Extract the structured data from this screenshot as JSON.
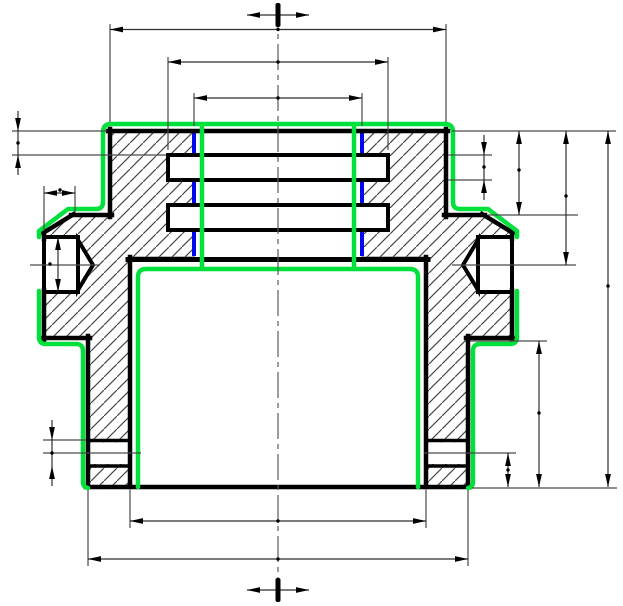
{
  "canvas": {
    "width": 623,
    "height": 606,
    "background": "#ffffff"
  },
  "colors": {
    "outline": "#000000",
    "hatch": "#474747",
    "thin": "#4a4a4a",
    "dim": "#2e2e2e",
    "arrow": "#000000",
    "highlight_green": "#00e13c",
    "highlight_blue": "#0008f0",
    "white": "#ffffff",
    "centerline": "#5a5a5a"
  },
  "strokes": {
    "outline": 4.5,
    "feature": 4,
    "groove": 3.5,
    "green": 4.5,
    "blue": 4,
    "thin": 1.2,
    "dim": 1.2,
    "hatch": 1.2,
    "hatch_period": 13
  },
  "drawing": {
    "hatch_regions": [
      {
        "name": "section-hatch-left",
        "points": [
          [
            110,
            131
          ],
          [
            194,
            131
          ],
          [
            194,
            257
          ],
          [
            130,
            257
          ],
          [
            130,
            487
          ],
          [
            88,
            487
          ],
          [
            88,
            338
          ],
          [
            44,
            338
          ],
          [
            44,
            233
          ],
          [
            73,
            215
          ],
          [
            110,
            215
          ]
        ]
      },
      {
        "name": "section-hatch-right",
        "points": [
          [
            446,
            131
          ],
          [
            362,
            131
          ],
          [
            362,
            257
          ],
          [
            426,
            257
          ],
          [
            426,
            487
          ],
          [
            468,
            487
          ],
          [
            468,
            338
          ],
          [
            512,
            338
          ],
          [
            512,
            233
          ],
          [
            483,
            215
          ],
          [
            446,
            215
          ]
        ]
      }
    ],
    "white_shapes": [
      {
        "name": "groove-band-left",
        "type": "rect",
        "x": 86,
        "y": 442.5,
        "w": 46,
        "h": 21.5,
        "stroke": false
      },
      {
        "name": "groove-band-right",
        "type": "rect",
        "x": 424,
        "y": 442.5,
        "w": 46,
        "h": 21.5,
        "stroke": false
      },
      {
        "name": "side-port-bore-left",
        "type": "rect",
        "x": 44,
        "y": 237,
        "w": 34,
        "h": 55,
        "stroke": true
      },
      {
        "name": "side-port-cone-left",
        "type": "poly",
        "points": [
          [
            78,
            240
          ],
          [
            93,
            265
          ],
          [
            78,
            290
          ]
        ],
        "stroke": true
      },
      {
        "name": "side-port-bore-right",
        "type": "rect",
        "x": 478,
        "y": 237,
        "w": 34,
        "h": 55,
        "stroke": true
      },
      {
        "name": "side-port-cone-right",
        "type": "poly",
        "points": [
          [
            478,
            240
          ],
          [
            463,
            265
          ],
          [
            478,
            290
          ]
        ],
        "stroke": true
      },
      {
        "name": "internal-ring-upper",
        "type": "rect",
        "x": 168,
        "y": 155,
        "w": 220,
        "h": 25,
        "stroke": true
      },
      {
        "name": "internal-ring-lower",
        "type": "rect",
        "x": 168,
        "y": 205,
        "w": 220,
        "h": 25,
        "stroke": true
      }
    ],
    "groove_lines": [
      {
        "name": "groove-left-top-edge",
        "x1": 86,
        "y1": 440.5,
        "x2": 132,
        "y2": 440.5
      },
      {
        "name": "groove-left-bottom-edge",
        "x1": 86,
        "y1": 466,
        "x2": 132,
        "y2": 466
      },
      {
        "name": "groove-right-top-edge",
        "x1": 424,
        "y1": 440.5,
        "x2": 470,
        "y2": 440.5
      },
      {
        "name": "groove-right-bottom-edge",
        "x1": 424,
        "y1": 466,
        "x2": 470,
        "y2": 466
      }
    ],
    "blue_edges": [
      {
        "name": "bore-edge-blue-left-1",
        "x": 194,
        "y1": 133,
        "y2": 153
      },
      {
        "name": "bore-edge-blue-left-2",
        "x": 194,
        "y1": 182,
        "y2": 203
      },
      {
        "name": "bore-edge-blue-left-3",
        "x": 194,
        "y1": 232,
        "y2": 256
      },
      {
        "name": "bore-edge-blue-right-1",
        "x": 362,
        "y1": 133,
        "y2": 153
      },
      {
        "name": "bore-edge-blue-right-2",
        "x": 362,
        "y1": 182,
        "y2": 203
      },
      {
        "name": "bore-edge-blue-right-3",
        "x": 362,
        "y1": 232,
        "y2": 256
      }
    ],
    "outline_segments": [
      {
        "name": "top-face",
        "x1": 108,
        "y1": 131,
        "x2": 448,
        "y2": 131,
        "w": 4.5
      },
      {
        "name": "outer-wall-left",
        "x1": 110,
        "y1": 129,
        "x2": 110,
        "y2": 217,
        "w": 4.5
      },
      {
        "name": "step-face-left",
        "x1": 112,
        "y1": 215,
        "x2": 71,
        "y2": 215,
        "w": 4.5
      },
      {
        "name": "chamfer-left",
        "x1": 74,
        "y1": 214,
        "x2": 43,
        "y2": 233,
        "w": 4.5
      },
      {
        "name": "flat-left-upper",
        "x1": 44,
        "y1": 231,
        "x2": 44,
        "y2": 239,
        "w": 4.5
      },
      {
        "name": "flat-left-lower",
        "x1": 44,
        "y1": 290,
        "x2": 44,
        "y2": 340,
        "w": 4.5
      },
      {
        "name": "shoulder-left",
        "x1": 42,
        "y1": 338,
        "x2": 90,
        "y2": 338,
        "w": 4.5
      },
      {
        "name": "skirt-outer-left",
        "x1": 88,
        "y1": 336,
        "x2": 88,
        "y2": 487,
        "w": 4.5
      },
      {
        "name": "bottom-face",
        "x1": 86,
        "y1": 487,
        "x2": 470,
        "y2": 487,
        "w": 4.5
      },
      {
        "name": "cavity-wall-left",
        "x1": 130,
        "y1": 257,
        "x2": 130,
        "y2": 487,
        "w": 4.5
      },
      {
        "name": "cavity-ceiling",
        "x1": 128,
        "y1": 259.5,
        "x2": 428,
        "y2": 259.5,
        "w": 5
      },
      {
        "name": "cavity-wall-right",
        "x1": 426,
        "y1": 257,
        "x2": 426,
        "y2": 487,
        "w": 4.5
      },
      {
        "name": "skirt-outer-right",
        "x1": 468,
        "y1": 336,
        "x2": 468,
        "y2": 487,
        "w": 4.5
      },
      {
        "name": "shoulder-right",
        "x1": 466,
        "y1": 338,
        "x2": 514,
        "y2": 338,
        "w": 4.5
      },
      {
        "name": "flat-right-lower",
        "x1": 512,
        "y1": 290,
        "x2": 512,
        "y2": 340,
        "w": 4.5
      },
      {
        "name": "flat-right-upper",
        "x1": 512,
        "y1": 231,
        "x2": 512,
        "y2": 239,
        "w": 4.5
      },
      {
        "name": "chamfer-right",
        "x1": 482,
        "y1": 214,
        "x2": 513,
        "y2": 233,
        "w": 4.5
      },
      {
        "name": "step-face-right",
        "x1": 444,
        "y1": 215,
        "x2": 485,
        "y2": 215,
        "w": 4.5
      },
      {
        "name": "outer-wall-right",
        "x1": 446,
        "y1": 129,
        "x2": 446,
        "y2": 217,
        "w": 4.5
      },
      {
        "name": "port-left-bottom-edge",
        "x1": 78,
        "y1": 237,
        "x2": 78,
        "y2": 292,
        "w": 4
      },
      {
        "name": "port-right-bottom-edge",
        "x1": 478,
        "y1": 237,
        "x2": 478,
        "y2": 292,
        "w": 4
      }
    ],
    "green_edges": [
      {
        "name": "highlight-outer-top",
        "d": "M 39,237 L 39,231 L 68,209 L 96,209 Q 103,209 103,202 L 103,132 Q 103,124 111,124 L 445,124 Q 453,124 453,132 L 453,202 Q 453,209 460,209 L 488,209 L 517,231 L 517,237"
      },
      {
        "name": "highlight-outer-left",
        "d": "M 39,291 L 39,337 Q 39,344 46,344 L 76,344 Q 83,344 83,351 L 83,482 Q 83,487 88,488"
      },
      {
        "name": "highlight-outer-right",
        "d": "M 517,291 L 517,337 Q 517,344 510,344 L 480,344 Q 473,344 473,351 L 473,482 Q 473,487 468,488"
      },
      {
        "name": "highlight-cavity",
        "d": "M 138,487 L 138,277 Q 138,269 146,269 L 410,269 Q 418,269 418,277 L 418,487"
      },
      {
        "name": "highlight-bore-left",
        "d": "M 202,126 L 202,268"
      },
      {
        "name": "highlight-bore-right",
        "d": "M 354,126 L 354,268"
      }
    ],
    "thin_lines": [
      {
        "name": "ext-top-left",
        "x1": 110,
        "y1": 24,
        "x2": 110,
        "y2": 122
      },
      {
        "name": "ext-top-right",
        "x1": 446,
        "y1": 24,
        "x2": 446,
        "y2": 122
      },
      {
        "name": "ext-ring-left",
        "x1": 168,
        "y1": 57,
        "x2": 168,
        "y2": 150
      },
      {
        "name": "ext-ring-right",
        "x1": 388,
        "y1": 57,
        "x2": 388,
        "y2": 150
      },
      {
        "name": "ext-bore-left",
        "x1": 194,
        "y1": 93,
        "x2": 194,
        "y2": 126
      },
      {
        "name": "ext-bore-right",
        "x1": 362,
        "y1": 93,
        "x2": 362,
        "y2": 126
      },
      {
        "name": "ext-topface-left",
        "x1": 12,
        "y1": 131,
        "x2": 107,
        "y2": 131
      },
      {
        "name": "ext-ringtop-left",
        "x1": 12,
        "y1": 155,
        "x2": 166,
        "y2": 155
      },
      {
        "name": "ext-topface-right",
        "x1": 452,
        "y1": 131,
        "x2": 616,
        "y2": 131
      },
      {
        "name": "ext-ringtop-right",
        "x1": 448,
        "y1": 155,
        "x2": 492,
        "y2": 155
      },
      {
        "name": "ext-ringbot-right",
        "x1": 448,
        "y1": 180,
        "x2": 492,
        "y2": 180
      },
      {
        "name": "ext-step-right",
        "x1": 488,
        "y1": 215,
        "x2": 578,
        "y2": 215
      },
      {
        "name": "port-axis-left",
        "x1": 30,
        "y1": 265,
        "x2": 100,
        "y2": 265
      },
      {
        "name": "port-axis-right",
        "x1": 452,
        "y1": 265,
        "x2": 576,
        "y2": 265
      },
      {
        "name": "ext-shoulder-right",
        "x1": 470,
        "y1": 341,
        "x2": 547,
        "y2": 341
      },
      {
        "name": "ext-groove-top-left",
        "x1": 43,
        "y1": 440,
        "x2": 86,
        "y2": 440
      },
      {
        "name": "groove-mid-left",
        "x1": 43,
        "y1": 453,
        "x2": 141,
        "y2": 453
      },
      {
        "name": "groove-mid-right",
        "x1": 424,
        "y1": 453,
        "x2": 516,
        "y2": 453
      },
      {
        "name": "ext-bottom-right",
        "x1": 472,
        "y1": 488,
        "x2": 617,
        "y2": 488
      },
      {
        "name": "ext-chamfer-a",
        "x1": 44,
        "y1": 186,
        "x2": 44,
        "y2": 231
      },
      {
        "name": "ext-chamfer-b",
        "x1": 75,
        "y1": 186,
        "x2": 75,
        "y2": 213
      },
      {
        "name": "ext-cavity-left",
        "x1": 130,
        "y1": 490,
        "x2": 130,
        "y2": 528
      },
      {
        "name": "ext-cavity-right",
        "x1": 426,
        "y1": 490,
        "x2": 426,
        "y2": 528
      },
      {
        "name": "ext-skirt-left",
        "x1": 88,
        "y1": 490,
        "x2": 88,
        "y2": 566
      },
      {
        "name": "ext-skirt-right",
        "x1": 468,
        "y1": 490,
        "x2": 468,
        "y2": 566
      }
    ],
    "centerlines": [
      {
        "name": "vertical-centerline",
        "x1": 278,
        "y1": 3,
        "x2": 278,
        "y2": 601,
        "dash": "26,5,5,5"
      }
    ],
    "dimensions": [
      {
        "name": "dim-overall-width",
        "type": "h",
        "pos": 29.5,
        "a": 110,
        "b": 446,
        "style": "in",
        "dot": [
          278,
          29.5
        ]
      },
      {
        "name": "dim-ring-groove-dia",
        "type": "h",
        "pos": 62,
        "a": 168,
        "b": 388,
        "style": "in",
        "dot": [
          278,
          62
        ]
      },
      {
        "name": "dim-bore-dia",
        "type": "h",
        "pos": 98,
        "a": 194,
        "b": 362,
        "style": "in",
        "dot": [
          278,
          98
        ]
      },
      {
        "name": "dim-cavity-dia",
        "type": "h",
        "pos": 521,
        "a": 130,
        "b": 426,
        "style": "in",
        "dot": [
          278,
          521
        ]
      },
      {
        "name": "dim-skirt-outer-dia",
        "type": "h",
        "pos": 559,
        "a": 88,
        "b": 468,
        "style": "in",
        "dot": [
          278,
          559
        ]
      },
      {
        "name": "dim-chamfer-width",
        "type": "h",
        "pos": 193,
        "a": 44,
        "b": 75,
        "style": "in",
        "dot": [
          60,
          190
        ]
      },
      {
        "name": "dim-top-to-ring",
        "type": "v",
        "pos": 18,
        "a": 131,
        "b": 155,
        "style": "out",
        "dot": [
          18,
          143
        ]
      },
      {
        "name": "dim-port-dia",
        "type": "v",
        "pos": 58,
        "a": 237,
        "b": 292,
        "style": "in",
        "dot": [
          50,
          264
        ]
      },
      {
        "name": "dim-groove-width",
        "type": "v",
        "pos": 52,
        "a": 440,
        "b": 466,
        "style": "out",
        "dot": [
          52,
          453
        ]
      },
      {
        "name": "dim-ring-width",
        "type": "v",
        "pos": 484,
        "a": 155,
        "b": 180,
        "style": "out",
        "dot": [
          484,
          167
        ]
      },
      {
        "name": "dim-top-to-step",
        "type": "v",
        "pos": 519,
        "a": 131,
        "b": 215,
        "style": "in",
        "dot": [
          519,
          170
        ]
      },
      {
        "name": "dim-top-to-port-axis",
        "type": "v",
        "pos": 566,
        "a": 131,
        "b": 265,
        "style": "in",
        "dot": [
          566,
          196
        ]
      },
      {
        "name": "dim-shoulder-to-bottom",
        "type": "v",
        "pos": 539,
        "a": 341,
        "b": 487,
        "style": "in",
        "dot": [
          539,
          413
        ]
      },
      {
        "name": "dim-overall-height",
        "type": "v",
        "pos": 608,
        "a": 131,
        "b": 487,
        "style": "in",
        "dot": [
          608,
          286
        ]
      },
      {
        "name": "dim-groove-to-bottom",
        "type": "v",
        "pos": 508,
        "a": 453,
        "b": 487,
        "style": "in",
        "dot": [
          508,
          470
        ]
      }
    ],
    "center_marks": [
      {
        "name": "datum-mark-top",
        "x": 278,
        "y": 15,
        "span": 62,
        "bar_h": 24
      },
      {
        "name": "datum-mark-bottom",
        "x": 278,
        "y": 590,
        "span": 62,
        "bar_h": 24
      }
    ]
  }
}
